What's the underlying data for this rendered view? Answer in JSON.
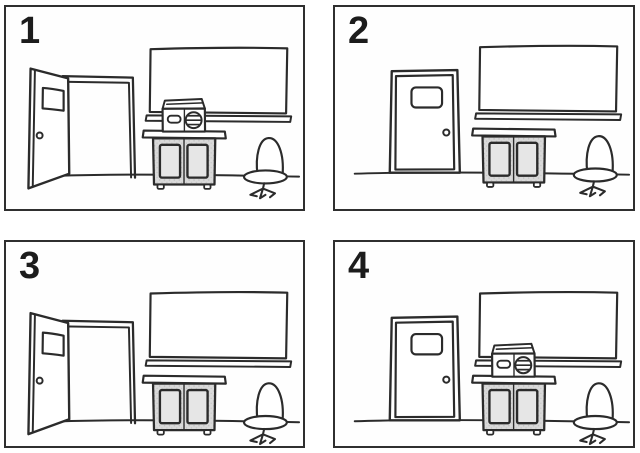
{
  "colors": {
    "ink": "#2b2b2b",
    "paper": "#ffffff",
    "panel_border": "#2f2f2f",
    "cabinet_gray": "#d9d9d9",
    "stipple_dot": "#bcbcbc",
    "inner_panel_gray": "#e6e6e6",
    "number_ink": "#1c1c1c"
  },
  "description": "Four-panel line-drawing sequence of a classroom corner with a door, chalkboard with chalk tray, two-door cabinet, swivel chair, and a portable tape player",
  "panels": [
    {
      "label": "1",
      "door": "open",
      "radio_on_cabinet": true,
      "objects": [
        "open door",
        "chalkboard",
        "chalk tray",
        "tape player on cabinet",
        "cabinet",
        "swivel chair",
        "floor line"
      ]
    },
    {
      "label": "2",
      "door": "closed",
      "radio_on_cabinet": false,
      "objects": [
        "closed door",
        "chalkboard",
        "chalk tray",
        "cabinet",
        "swivel chair",
        "floor line"
      ]
    },
    {
      "label": "3",
      "door": "open",
      "radio_on_cabinet": false,
      "objects": [
        "open door",
        "chalkboard",
        "chalk tray",
        "cabinet",
        "swivel chair",
        "floor line"
      ]
    },
    {
      "label": "4",
      "door": "closed",
      "radio_on_cabinet": true,
      "objects": [
        "closed door",
        "chalkboard",
        "chalk tray",
        "tape player on cabinet",
        "cabinet",
        "swivel chair",
        "floor line"
      ]
    }
  ]
}
